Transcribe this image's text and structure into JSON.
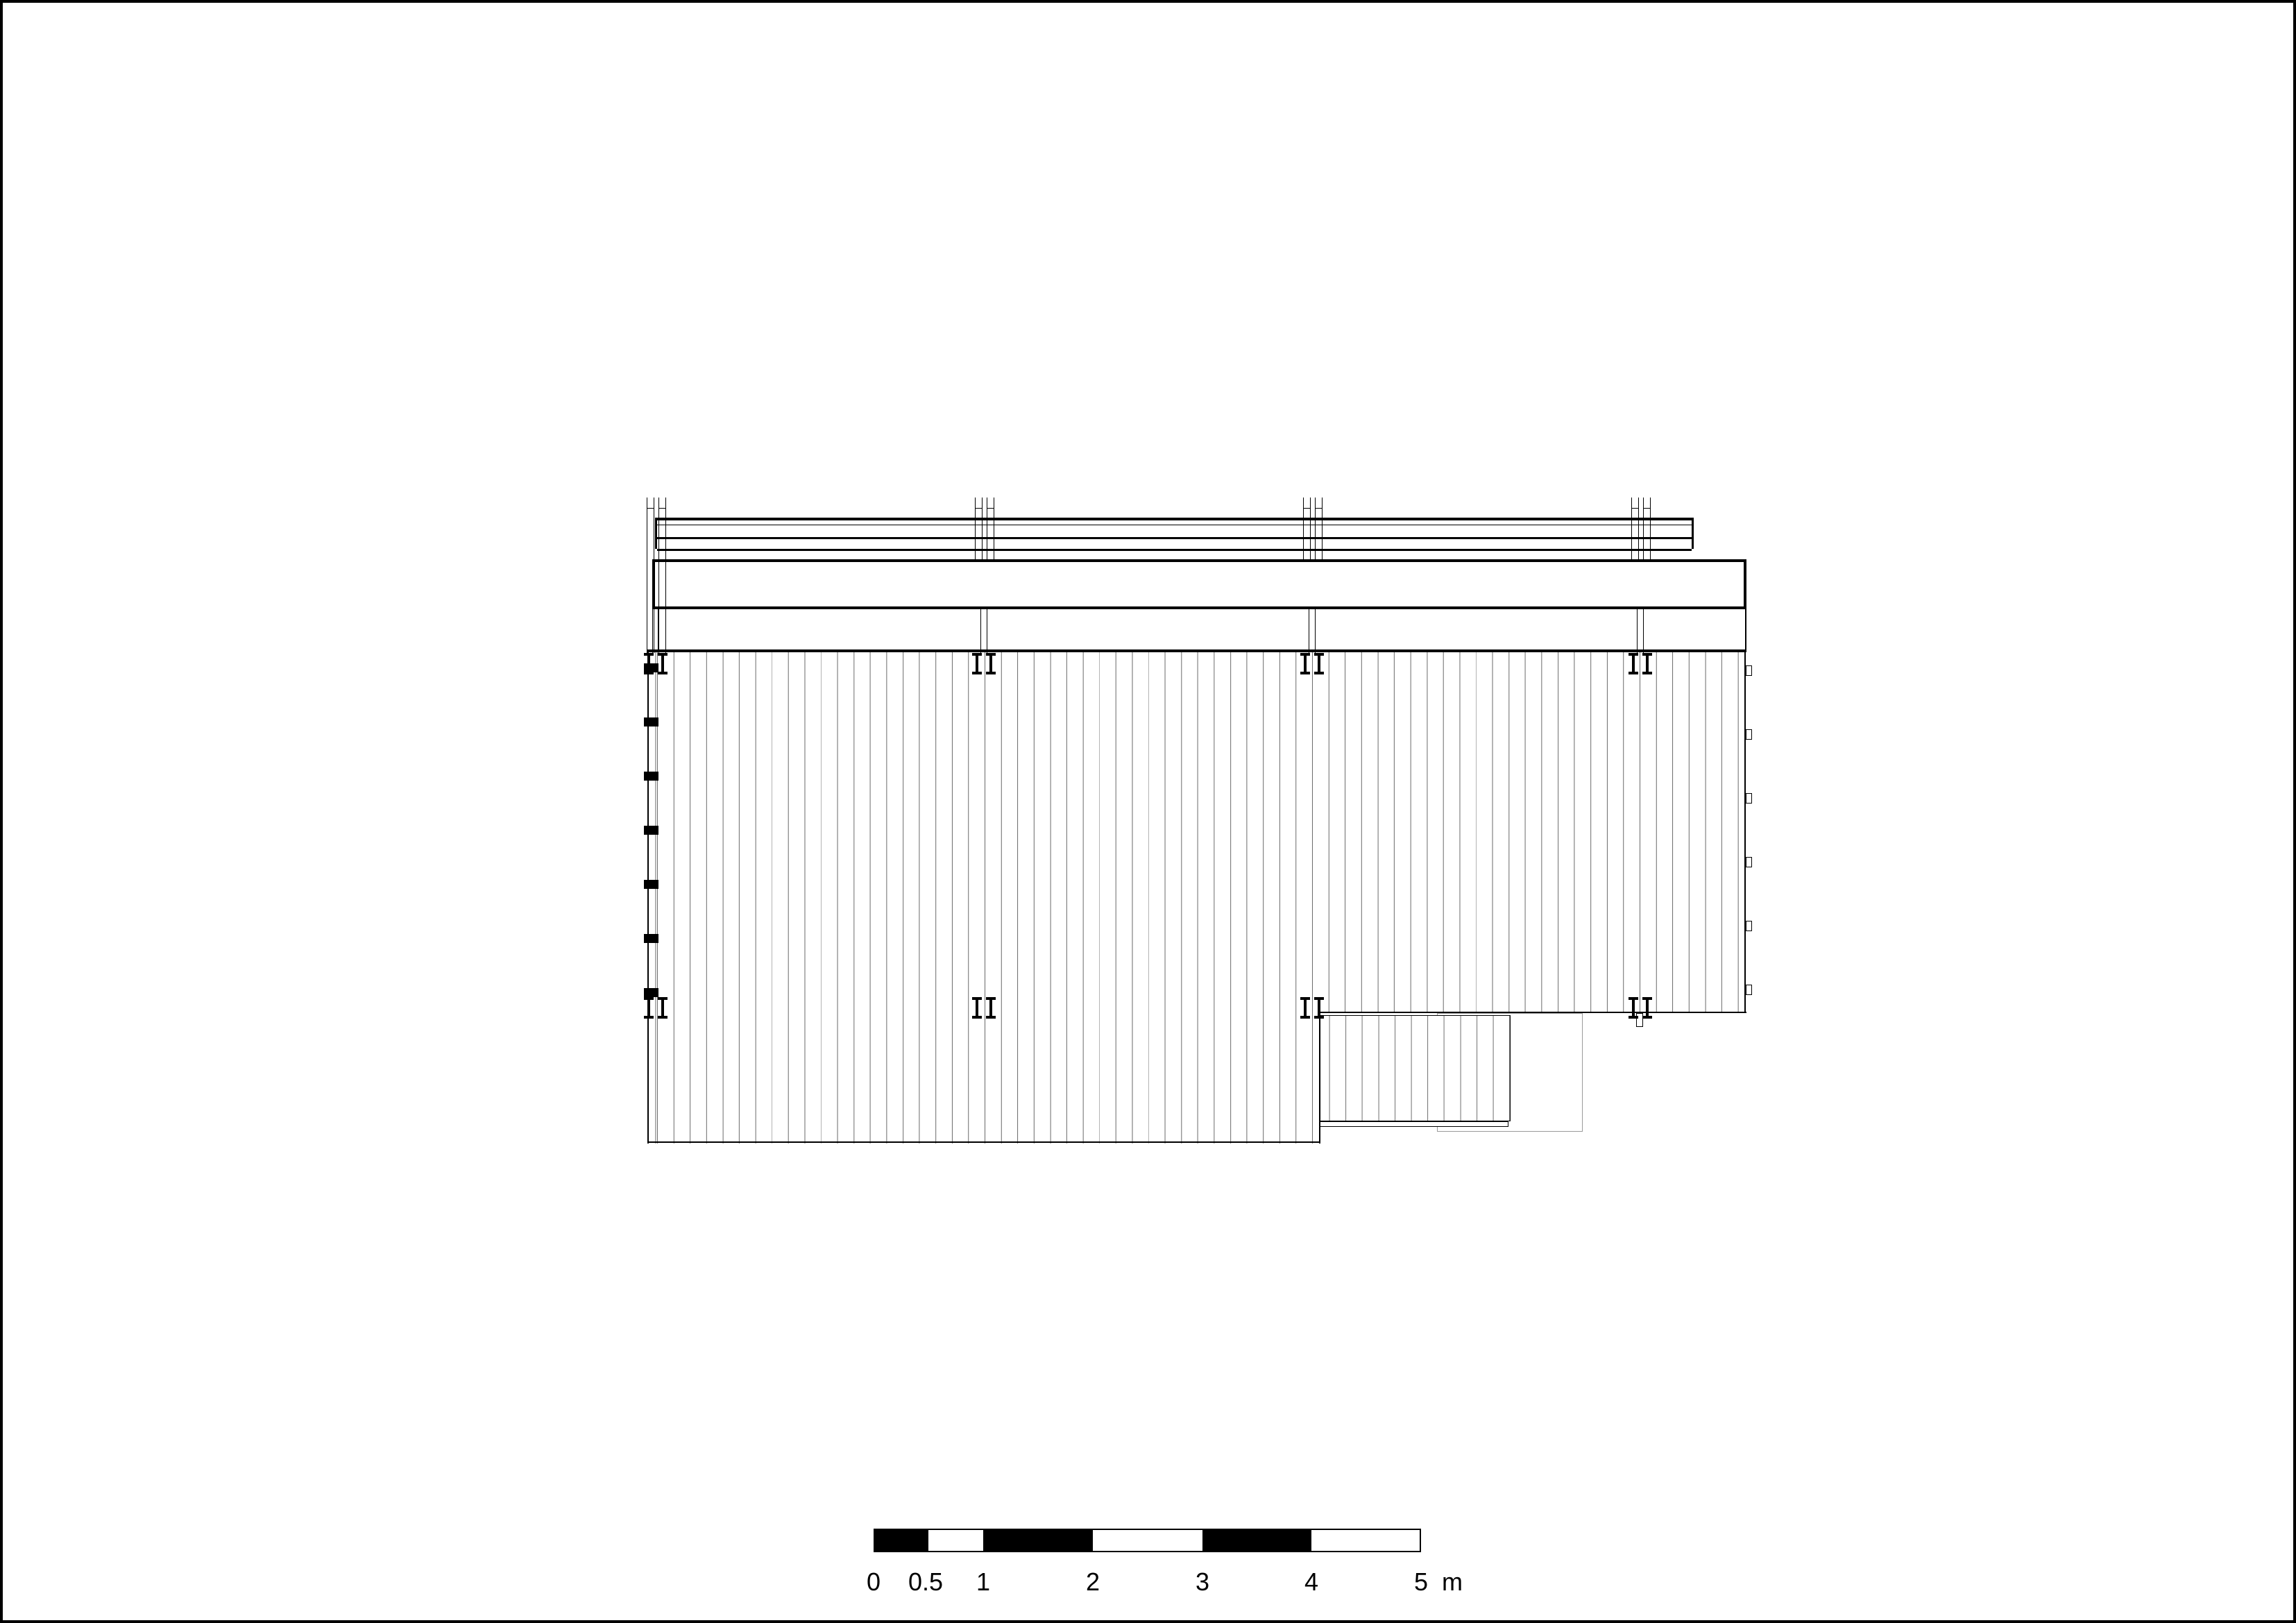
{
  "drawing": {
    "type": "architectural plan",
    "subject": "timber deck and pergola roof plan with step",
    "colors": {
      "ink": "#000000",
      "hatch": "#6e6e6e",
      "ghost_outline": "#999999",
      "paper": "#ffffff"
    },
    "elements": {
      "post_bays": 4,
      "post_fittings_per_row": 4,
      "left_edge_markers": 7,
      "right_edge_clips": 6
    }
  },
  "scale_bar": {
    "labels": [
      "0",
      "0.5",
      "1",
      "2",
      "3",
      "4",
      "5"
    ],
    "unit": "m",
    "ticks_m": [
      0,
      0.5,
      1,
      2,
      3,
      4,
      5
    ],
    "length_m": 5,
    "pattern": [
      "black",
      "white",
      "black",
      "white",
      "black",
      "white"
    ]
  }
}
